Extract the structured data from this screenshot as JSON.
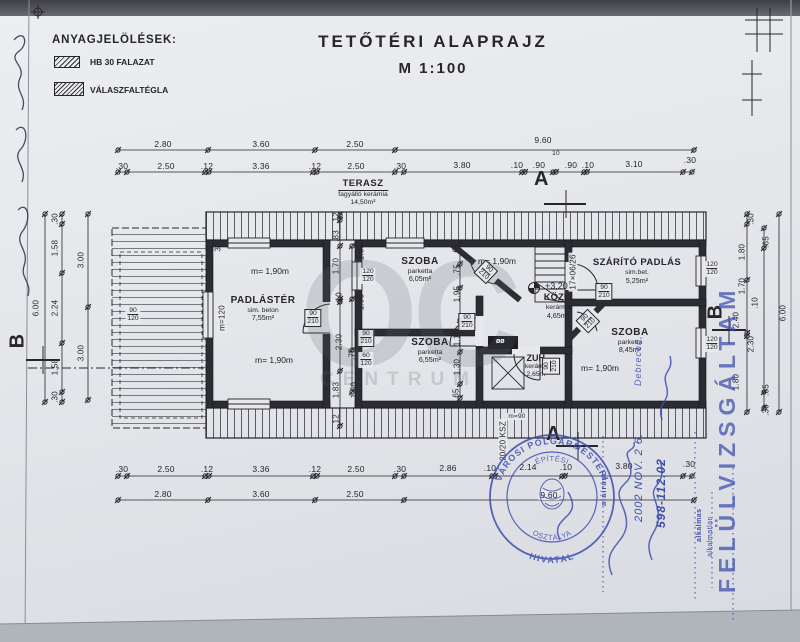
{
  "legend": {
    "title": "ANYAGJELÖLÉSEK:",
    "item1": "HB 30 FALAZAT",
    "item2": "VÁLASZFALTÉGLA"
  },
  "title": {
    "main": "TETŐTÉRI ALAPRAJZ",
    "scale": "M 1:100"
  },
  "markers": {
    "a": "A",
    "b": "B"
  },
  "watermark": {
    "big": "OC",
    "small": "CENTRUM"
  },
  "rooms": {
    "terasz": {
      "name": "TERASZ",
      "finish": "fagyálló kerámia",
      "area": "14,50m²"
    },
    "padlaster": {
      "name": "PADLÁSTÉR",
      "finish": "sim. beton",
      "area": "7,55m²",
      "h1": "m= 1,90m",
      "h2": "m= 1,90m",
      "m120": "m=120",
      "w30": "30"
    },
    "szoba1": {
      "name": "SZOBA",
      "finish": "parketta",
      "area": "6,05m²",
      "h": "m= 1,90m"
    },
    "szoba2": {
      "name": "SZOBA",
      "finish": "parketta",
      "area": "6,55m²"
    },
    "kozl": {
      "name": "KÖZL.",
      "finish": "kerámia",
      "area": "4,65m²",
      "level": "+3,20"
    },
    "zuh": {
      "name": "ZUH.",
      "finish": "kerámia",
      "area": "2,65m²",
      "fixture": "øø"
    },
    "szarito": {
      "name": "SZÁRÍTÓ PADLÁS",
      "finish": "sim.bet.",
      "area": "5,25m²",
      "stair": "17×06/26"
    },
    "szoba3": {
      "name": "SZOBA",
      "finish": "parketta",
      "area": "8,45m²",
      "h": "m= 1,90m"
    }
  },
  "sizes": {
    "d90": "90",
    "d210": "210",
    "w120": "120",
    "w90": "90",
    "s60": "60",
    "m90": "m=90",
    "ksz": "20/20 KSZ"
  },
  "dims": {
    "top1": [
      "2.80",
      "3.60",
      "2.50",
      "9.60"
    ],
    "top2": [
      ".30",
      "2.50",
      ".12",
      "3.36",
      ".12",
      "2.50",
      ".30",
      "3.80",
      ".10",
      ".90",
      "10",
      ".90",
      ".10",
      "3.10",
      ".30"
    ],
    "bot1": [
      ".30",
      "2.50",
      ".12",
      "3.36",
      ".12",
      "2.50",
      ".30",
      "2.86",
      ".10",
      "2.14",
      ".10",
      "3.80",
      ".30"
    ],
    "bot2": [
      "2.80",
      "3.60",
      "2.50",
      "9.60"
    ],
    "left": [
      ".30",
      "1.58",
      "2.24",
      "1.58",
      ".30",
      "3.00",
      "3.00",
      "6.00"
    ],
    "right": [
      ".30",
      ".65",
      "1.80",
      "1.70",
      ".10",
      "2.40",
      "2.30",
      "1.80",
      ".65",
      ".30",
      "6.00"
    ],
    "mid": [
      ".12",
      ".83",
      "1.70",
      ".10",
      "2.30",
      "1.83",
      ".12"
    ],
    "inner": [
      "1.80",
      "1.95",
      ".75",
      "1.50"
    ],
    "mid2": [
      "65",
      ".75",
      "1.95",
      "1.10",
      "1.30",
      "65"
    ]
  },
  "stamp": {
    "arc_top": "VÁROSI POLGÁRMESTERI",
    "arc_bottom": "· HIVATAL ·",
    "inner_top": "ÉPÍTÉSI",
    "inner_bottom": "OSZTÁLYA"
  },
  "blue": {
    "file_no": "598-112.02",
    "date": "2002 NOV. 2 6.",
    "ok": "alkalmas",
    "not_ok": "alkalmatlan",
    "sign": "aláírás",
    "review": "FELÜLVIZSGÁLTAM",
    "city": "Debrecen,"
  }
}
